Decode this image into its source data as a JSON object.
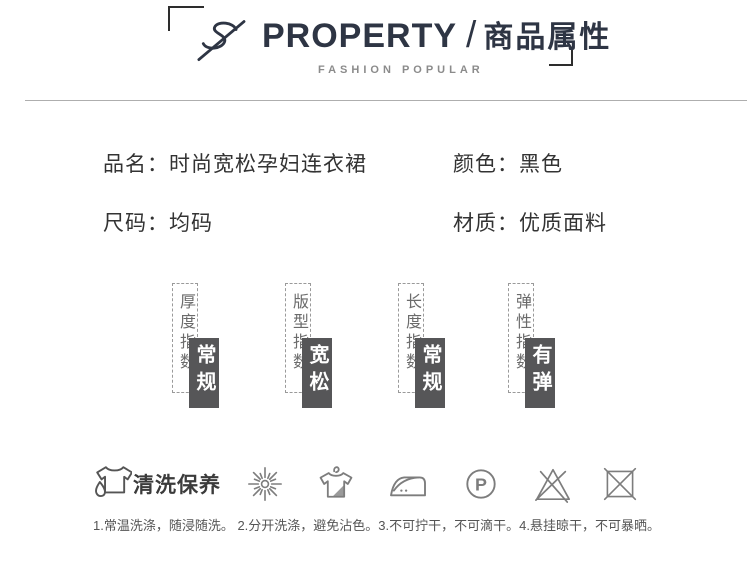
{
  "header": {
    "title_en": "PROPERTY",
    "separator": "/",
    "title_zh": "商品属性",
    "subtitle": "FASHION POPULAR"
  },
  "attributes": [
    {
      "label": "品名：",
      "value": "时尚宽松孕妇连衣裙"
    },
    {
      "label": "颜色：",
      "value": "黑色"
    },
    {
      "label": "尺码：",
      "value": "均码"
    },
    {
      "label": "材质：",
      "value": "优质面料"
    }
  ],
  "indicators": [
    {
      "label": "厚度指数",
      "value": "常规"
    },
    {
      "label": "版型指数",
      "value": "宽松"
    },
    {
      "label": "长度指数",
      "value": "常规"
    },
    {
      "label": "弹性指数",
      "value": "有弹"
    }
  ],
  "care": {
    "title": "清洗保养",
    "p_letter": "P",
    "icons": [
      "tshirt-droplet-icon",
      "sunlight-burst-icon",
      "hang-dry-shirt-icon",
      "iron-two-dots-icon",
      "professional-dryclean-p-icon",
      "do-not-bleach-icon",
      "do-not-tumble-dry-icon"
    ],
    "instructions": "1.常温洗涤，随浸随洗。 2.分开洗涤，避免沾色。3.不可拧干，不可滴干。4.悬挂晾干，不可暴晒。"
  },
  "colors": {
    "accent_dark": "#2e3544",
    "indicator_box": "#565658",
    "icon_stroke": "#7d7d7d",
    "dashed_border": "#9a9a9a"
  }
}
